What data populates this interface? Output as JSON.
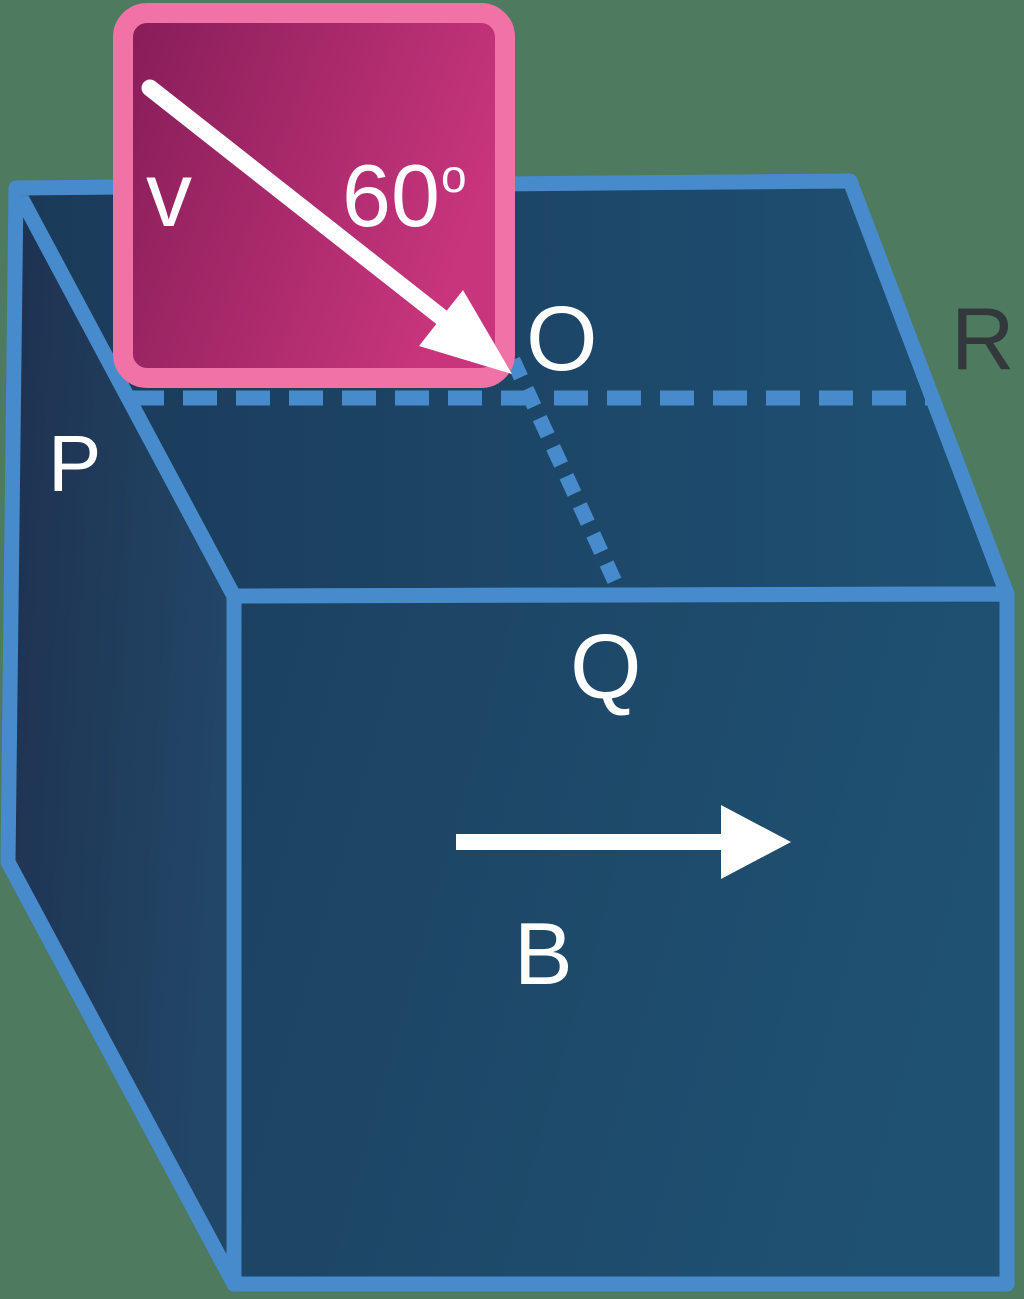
{
  "figure": {
    "kind": "physics-diagram",
    "description": "Cuboid PQR with magnetic field B along front face and inset panel showing velocity v at 60 degrees entering at point O"
  },
  "labels": {
    "velocity": "v",
    "angle_value": "60",
    "angle_degree_mark": "o",
    "point_O": "O",
    "point_P": "P",
    "point_Q": "Q",
    "point_R": "R",
    "field_B": "B"
  },
  "colors": {
    "background": "#4e7a60",
    "edge-blue": "#478bcc",
    "face-top-start": "#1b3a59",
    "face-top-end": "#1e5174",
    "face-front-start": "#1c4160",
    "face-front-end": "#1f5173",
    "face-side-start": "#1e3150",
    "face-side-end": "#224666",
    "panel-border": "#f172a4",
    "panel-fill-start": "#851d58",
    "panel-fill-end": "#c8357d",
    "label-white": "#ffffff",
    "label-dark": "#33383d"
  }
}
